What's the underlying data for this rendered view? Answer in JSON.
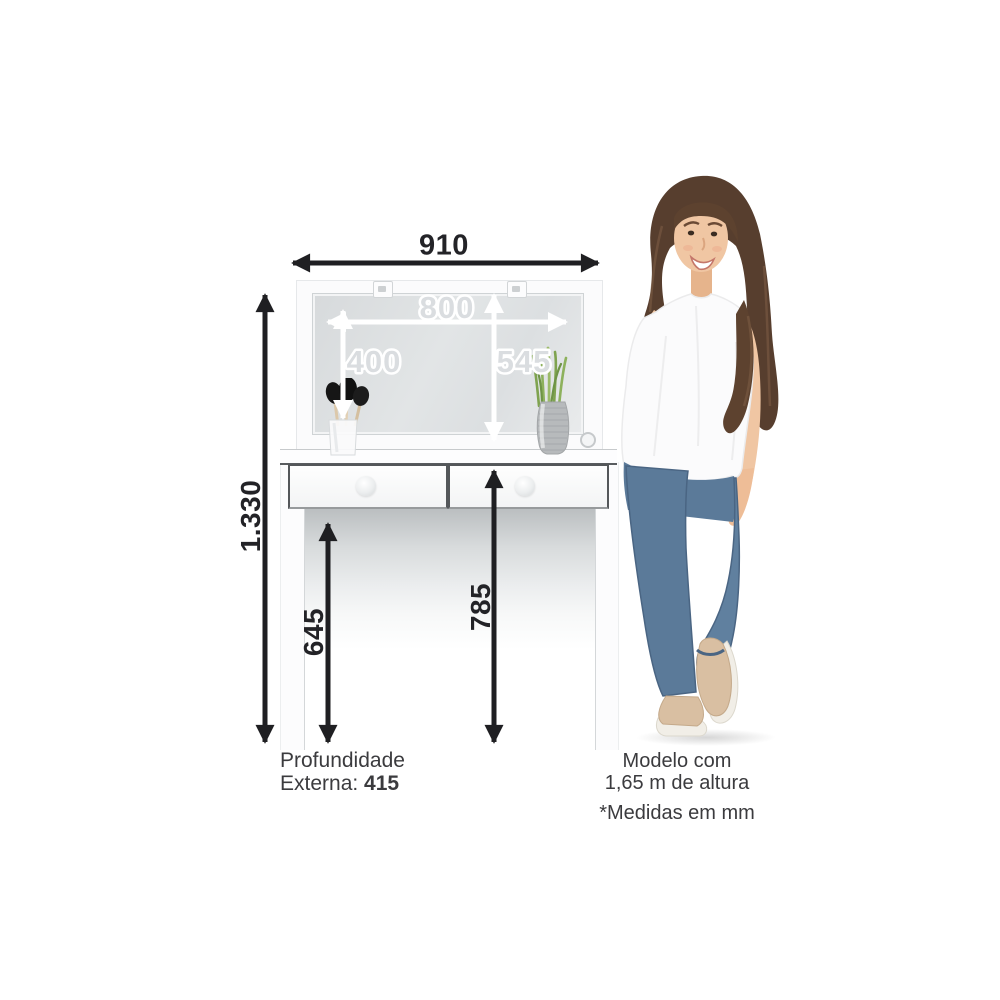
{
  "dimensions": {
    "total_width": "910",
    "mirror_width": "800",
    "mirror_height": "400",
    "panel_height": "545",
    "total_height": "1.330",
    "under_desk_clearance": "645",
    "tabletop_height": "785",
    "depth_line1": "Profundidade",
    "depth_line2": "Externa: ",
    "depth_value": "415"
  },
  "model_note": {
    "line1": "Modelo com",
    "line2": "1,65 m de altura"
  },
  "units_note": "*Medidas em mm",
  "colors": {
    "arrow_dark": "#1f1f22",
    "arrow_light": "#ffffff",
    "mirror_gray": "#dcdfe1",
    "drawer_outline": "#54575a",
    "denim_blue": "#5b7a99",
    "plant_green": "#7fa34f",
    "skin": "#f0c6a3",
    "hair_brown": "#573e2e",
    "text_dark": "#3b3b3e"
  }
}
